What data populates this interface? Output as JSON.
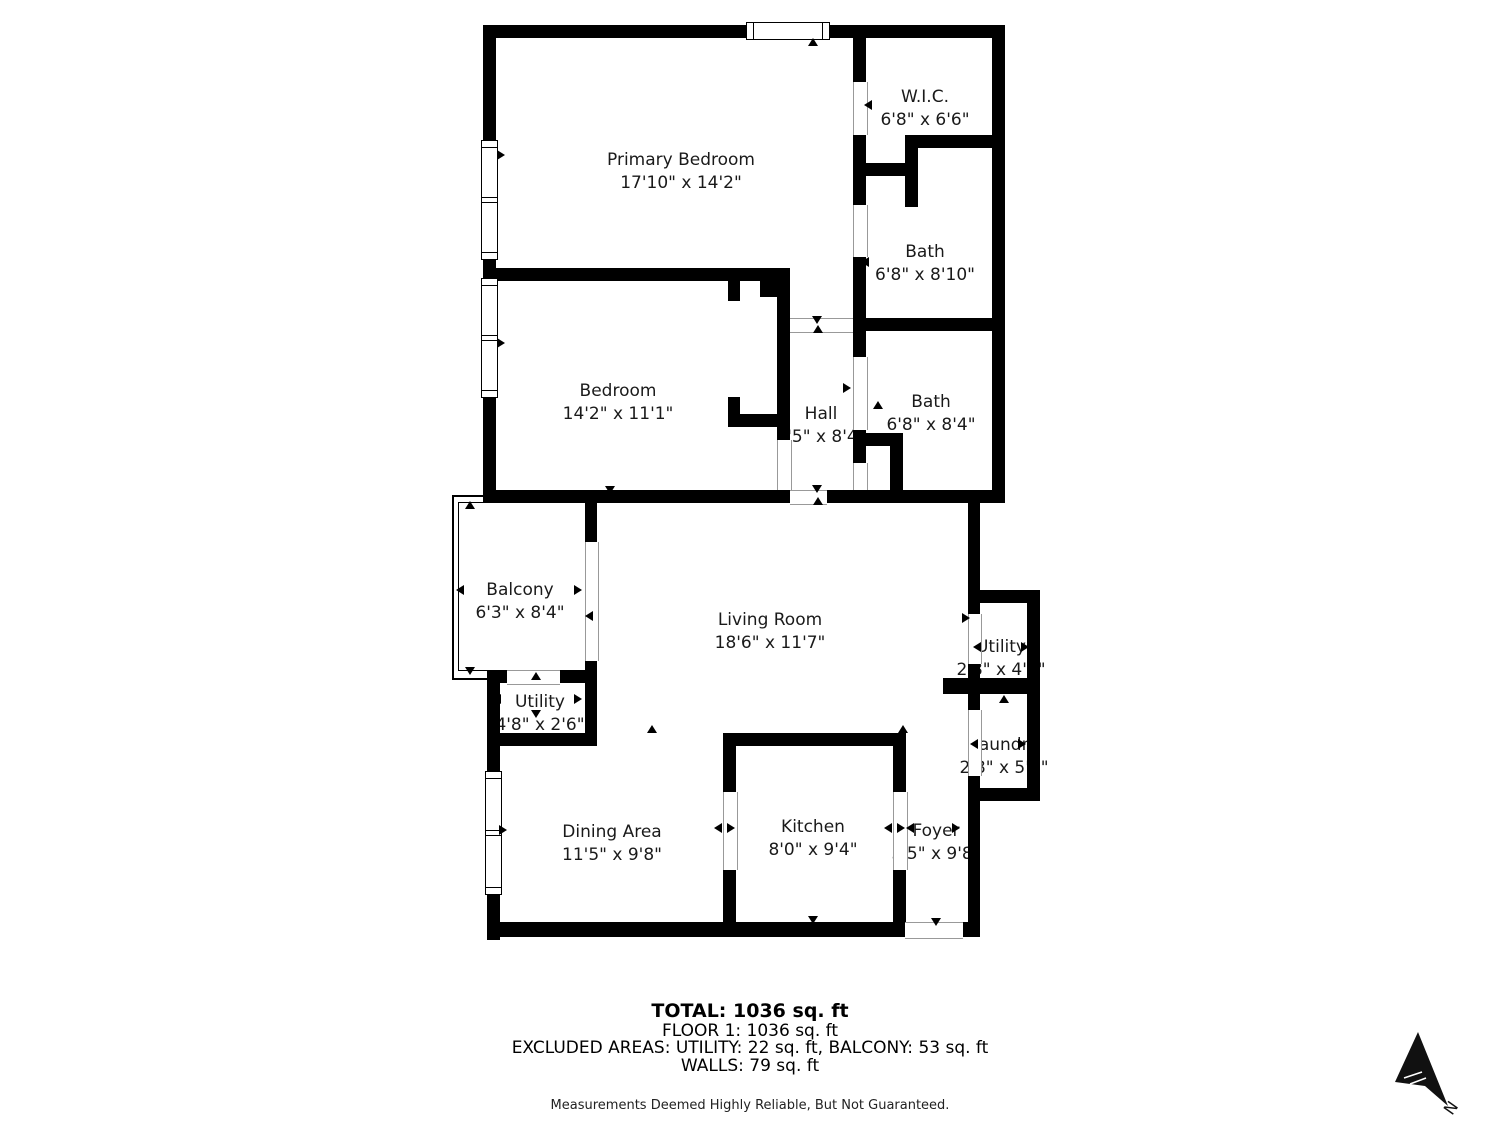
{
  "rooms": {
    "primary_bedroom": {
      "name": "Primary Bedroom",
      "dims": "17'10\" x 14'2\""
    },
    "wic": {
      "name": "W.I.C.",
      "dims": "6'8\" x 6'6\""
    },
    "bath_upper": {
      "name": "Bath",
      "dims": "6'8\" x 8'10\""
    },
    "bedroom": {
      "name": "Bedroom",
      "dims": "14'2\" x 11'1\""
    },
    "hall": {
      "name": "Hall",
      "dims": "3'5\" x 8'4\""
    },
    "bath_lower": {
      "name": "Bath",
      "dims": "6'8\" x 8'4\""
    },
    "balcony": {
      "name": "Balcony",
      "dims": "6'3\" x 8'4\""
    },
    "living_room": {
      "name": "Living Room",
      "dims": "18'6\" x 11'7\""
    },
    "utility_right": {
      "name": "Utility",
      "dims": "2'8\" x 4'1\""
    },
    "utility_left": {
      "name": "Utility",
      "dims": "4'8\" x 2'6\""
    },
    "laundry": {
      "name": "Laundry",
      "dims": "2'8\" x 5'1\""
    },
    "dining_area": {
      "name": "Dining Area",
      "dims": "11'5\" x 9'8\""
    },
    "kitchen": {
      "name": "Kitchen",
      "dims": "8'0\" x 9'4\""
    },
    "foyer": {
      "name": "Foyer",
      "dims": "3'5\" x 9'8\""
    }
  },
  "footer": {
    "total": "TOTAL: 1036 sq. ft",
    "floor": "FLOOR 1: 1036 sq. ft",
    "excluded": "EXCLUDED AREAS: UTILITY: 22 sq. ft, BALCONY: 53 sq. ft",
    "walls": "WALLS: 79 sq. ft",
    "disclaimer": "Measurements Deemed Highly Reliable, But Not Guaranteed."
  },
  "compass": {
    "label": "N"
  },
  "colors": {
    "wall": "#000000",
    "background": "#ffffff",
    "text": "#1a1a1a"
  }
}
